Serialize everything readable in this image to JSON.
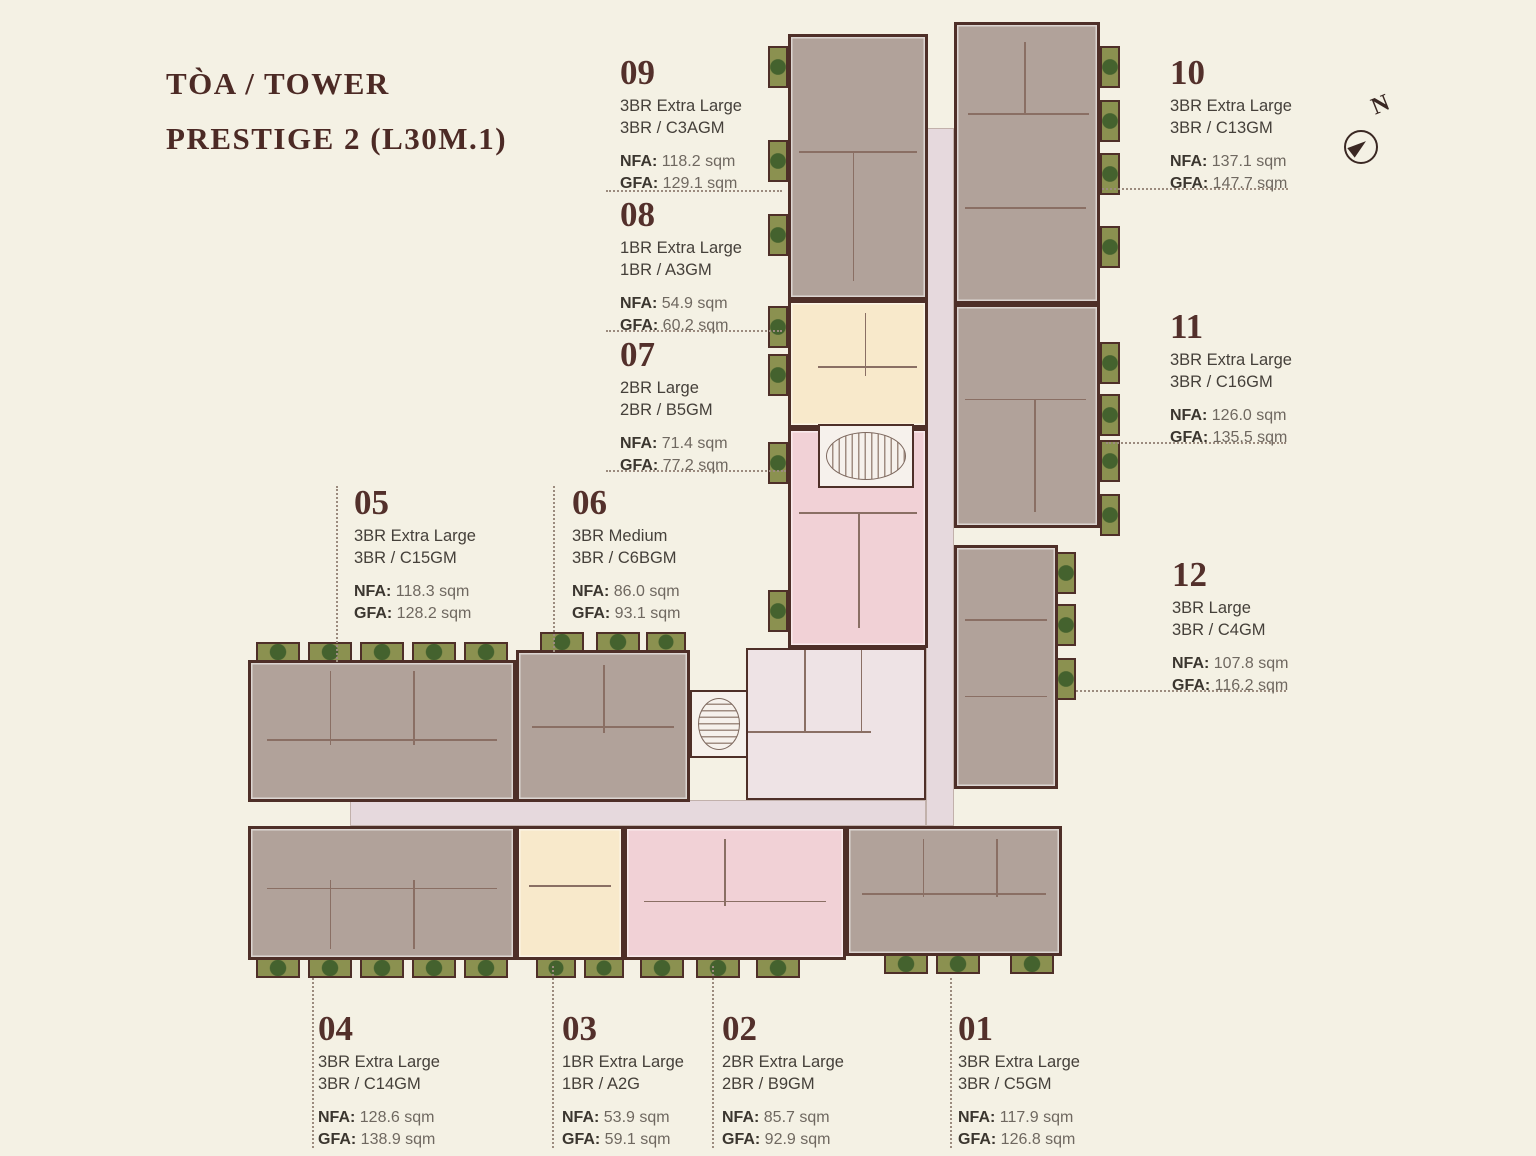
{
  "title": {
    "line1": "TÒA / TOWER",
    "line2": "PRESTIGE 2 (L30M.1)"
  },
  "compass": {
    "label": "N"
  },
  "labels": {
    "nfa": "NFA:",
    "gfa": "GFA:"
  },
  "units": [
    {
      "number": "01",
      "type": "3BR Extra Large",
      "code": "3BR / C5GM",
      "nfa": "117.9 sqm",
      "gfa": "126.8 sqm"
    },
    {
      "number": "02",
      "type": "2BR Extra Large",
      "code": "2BR / B9GM",
      "nfa": "85.7 sqm",
      "gfa": "92.9 sqm"
    },
    {
      "number": "03",
      "type": "1BR Extra Large",
      "code": "1BR / A2G",
      "nfa": "53.9 sqm",
      "gfa": "59.1 sqm"
    },
    {
      "number": "04",
      "type": "3BR Extra Large",
      "code": "3BR / C14GM",
      "nfa": "128.6 sqm",
      "gfa": "138.9 sqm"
    },
    {
      "number": "05",
      "type": "3BR Extra Large",
      "code": "3BR / C15GM",
      "nfa": "118.3 sqm",
      "gfa": "128.2 sqm"
    },
    {
      "number": "06",
      "type": "3BR Medium",
      "code": "3BR / C6BGM",
      "nfa": "86.0 sqm",
      "gfa": "93.1 sqm"
    },
    {
      "number": "07",
      "type": "2BR Large",
      "code": "2BR / B5GM",
      "nfa": "71.4 sqm",
      "gfa": "77.2 sqm"
    },
    {
      "number": "08",
      "type": "1BR Extra Large",
      "code": "1BR / A3GM",
      "nfa": "54.9 sqm",
      "gfa": "60.2 sqm"
    },
    {
      "number": "09",
      "type": "3BR Extra Large",
      "code": "3BR / C3AGM",
      "nfa": "118.2 sqm",
      "gfa": "129.1 sqm"
    },
    {
      "number": "10",
      "type": "3BR Extra Large",
      "code": "3BR / C13GM",
      "nfa": "137.1 sqm",
      "gfa": "147.7 sqm"
    },
    {
      "number": "11",
      "type": "3BR Extra Large",
      "code": "3BR / C16GM",
      "nfa": "126.0 sqm",
      "gfa": "135.5 sqm"
    },
    {
      "number": "12",
      "type": "3BR Large",
      "code": "3BR / C4GM",
      "nfa": "107.8 sqm",
      "gfa": "116.2 sqm"
    }
  ],
  "plan": {
    "colors": {
      "background": "#f4f1e4",
      "wall": "#4e2f28",
      "room-line": "#8a6f64",
      "unit-3br": "#b1a29a",
      "unit-2br": "#f1d1d6",
      "unit-1br": "#f8e9cb",
      "corridor": "#e6d9dd",
      "lobby": "#eee3e5",
      "planter": "#8b9150",
      "plant": "#44622e",
      "leader-dot": "#9b8b7e",
      "number-text": "#53302b",
      "body-text": "#45403a",
      "muted-text": "#6f6860",
      "title-text": "#4c2a25"
    }
  }
}
